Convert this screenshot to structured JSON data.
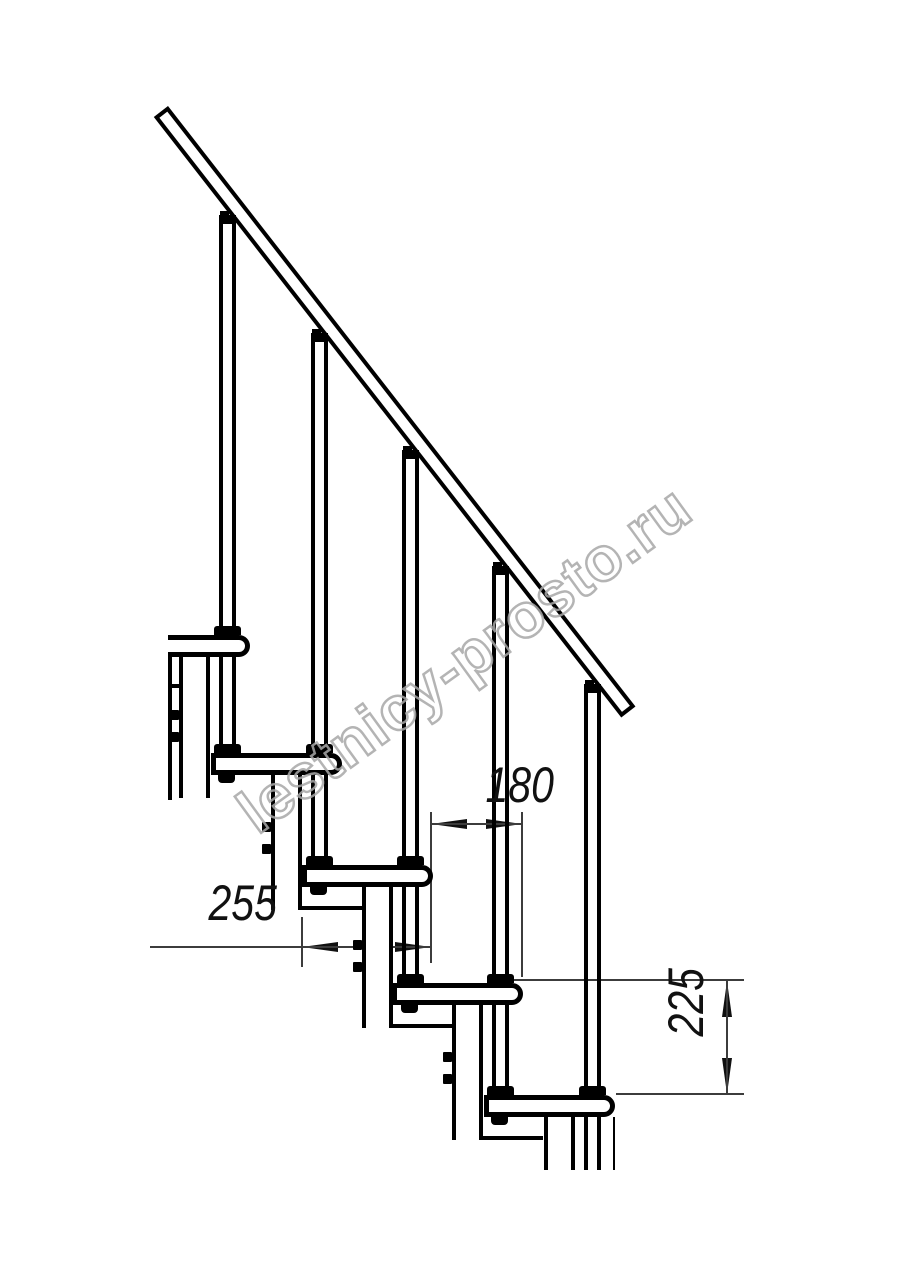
{
  "drawing": {
    "title": "Modular staircase side elevation drawing",
    "dimensions": {
      "run_small": {
        "label": "180",
        "orientation": "horizontal"
      },
      "run_large": {
        "label": "255",
        "orientation": "horizontal"
      },
      "rise": {
        "label": "225",
        "orientation": "vertical"
      }
    },
    "watermark": {
      "text": "lestnicy-prosto.ru",
      "outline_color": "#a8a8a8"
    },
    "colors": {
      "background": "#ffffff",
      "line": "#000000",
      "dimension_line": "#3c3c3c",
      "dimension_text": "#111111"
    }
  }
}
